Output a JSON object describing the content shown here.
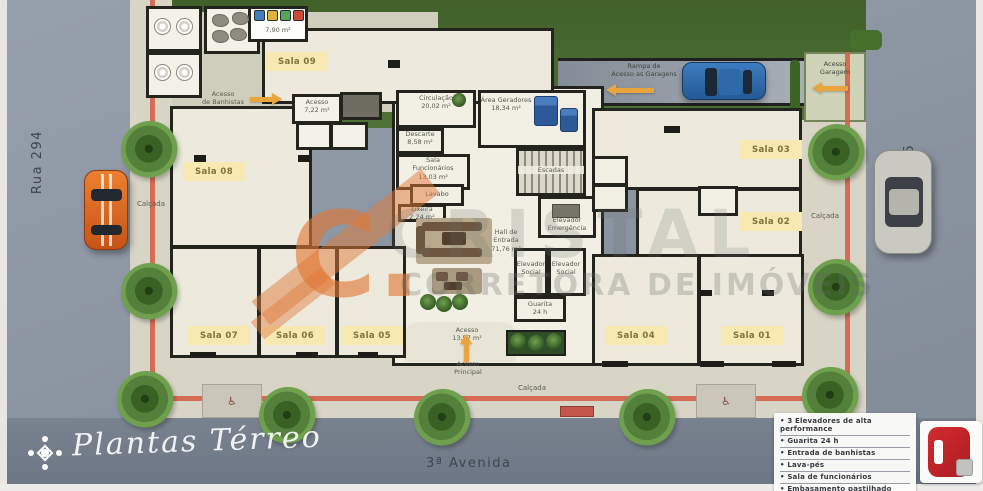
{
  "plan": {
    "streets": {
      "left": "Rua 294",
      "right": "Rua 296",
      "bottom": "3ª Avenida"
    },
    "sidewalk_label": "Calçada",
    "rooms": [
      {
        "id": "sala-09",
        "label": "Sala 09"
      },
      {
        "id": "sala-08",
        "label": "Sala 08"
      },
      {
        "id": "sala-07",
        "label": "Sala 07"
      },
      {
        "id": "sala-06",
        "label": "Sala 06"
      },
      {
        "id": "sala-05",
        "label": "Sala 05"
      },
      {
        "id": "sala-04",
        "label": "Sala 04"
      },
      {
        "id": "sala-03",
        "label": "Sala 03"
      },
      {
        "id": "sala-02",
        "label": "Sala 02"
      },
      {
        "id": "sala-01",
        "label": "Sala 01"
      }
    ],
    "areas": {
      "circulacao": "Circulação\n20,02 m²",
      "descarte": "Descarte\n8,58 m²",
      "sala_funcionarios": "Sala\nFuncionários\n13,03 m²",
      "lavabo": "Lavabo",
      "lixeira": "Lixeira\n2,24 m²",
      "hall_entrada": "Hall de\nEntrada\n71,76 m²",
      "escadas": "Escadas",
      "elevador_emergencia": "Elevador\nEmergência",
      "elevador_social": "Elevador\nSocial",
      "guarita": "Guarita\n24 h",
      "area_geradores": "Área Geradores\n18,34 m²",
      "acesso_sala09": "Acesso\n7,22 m²",
      "acesso_entrada": "Acesso\n13,57 m²",
      "lixeiras_area": "7,90 m²"
    },
    "accesses": {
      "rampa_garagens": "Rampa de\nAcesso as Garagens",
      "acesso_garagem": "Acesso\nGaragem",
      "acesso_banhistas": "Acesso\nde Banhistas",
      "acesso_principal": "Acesso\nPrincipal"
    },
    "watermark": {
      "logo": "C.",
      "brand": "CRISTAL",
      "tagline": "CORRETORA DE IMÓVEIS"
    },
    "legend": {
      "items": [
        "3 Elevadores de alta performance",
        "Guarita 24 h",
        "Entrada de banhistas",
        "Lava-pés",
        "Sala de funcionários",
        "Embasamento pastilhado"
      ]
    },
    "footer": {
      "plan_title": "Plantas Térreo"
    },
    "icons": {
      "wheelchair": "♿"
    }
  }
}
